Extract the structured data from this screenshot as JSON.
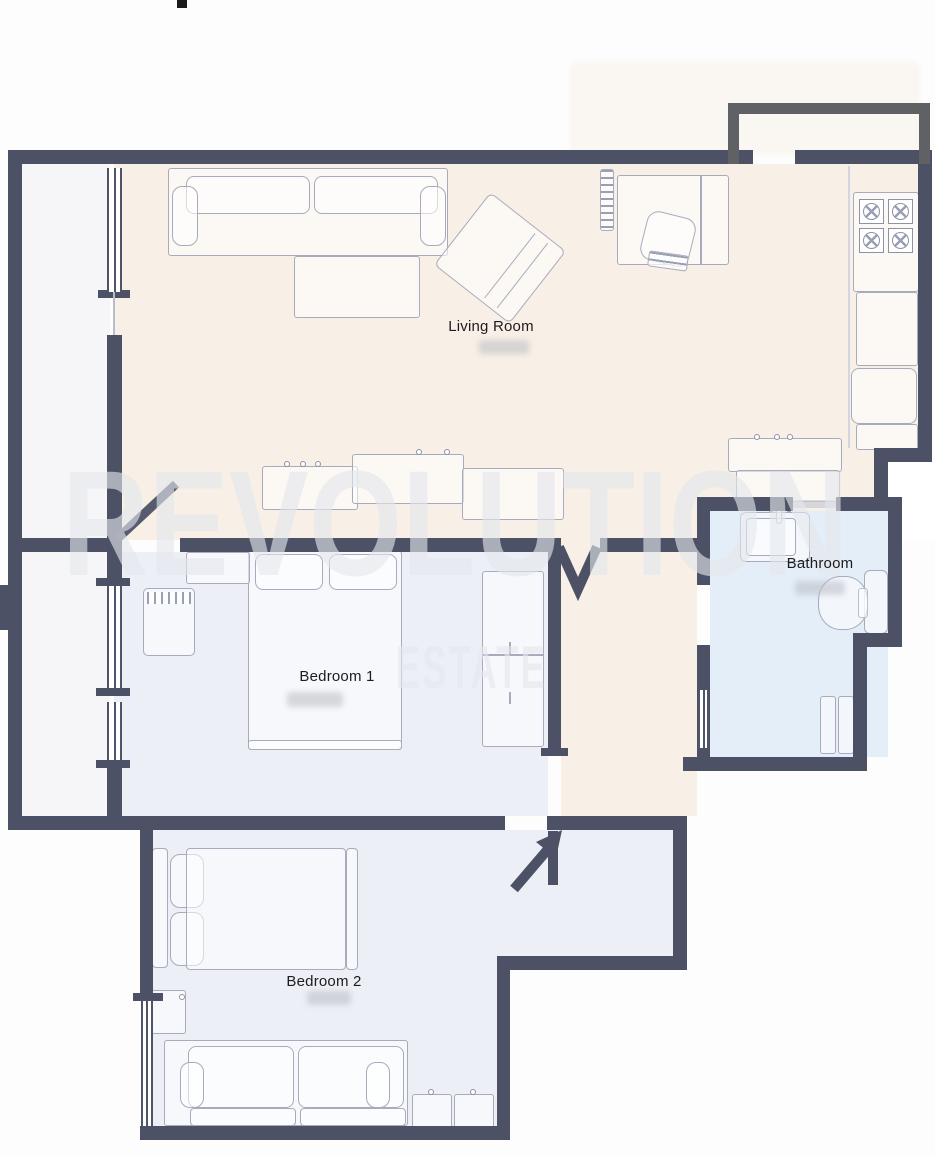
{
  "plan": {
    "type": "apartment-floor-plan",
    "watermark": {
      "line1": "REVOLUTION",
      "line2": "ESTATE"
    },
    "rooms": [
      {
        "id": "living-room",
        "label": "Living Room",
        "floor_color": "#f8efe6",
        "measurement_redacted": true,
        "furniture": [
          "sofa",
          "ottoman",
          "armchair",
          "tv-unit",
          "desk",
          "desk-chair",
          "kitchen-stove",
          "kitchen-counter",
          "kitchen-fridge",
          "kitchen-sink-counter",
          "island-counters"
        ]
      },
      {
        "id": "bedroom-1",
        "label": "Bedroom 1",
        "floor_color": "#edeff6",
        "measurement_redacted": true,
        "furniture": [
          "double-bed",
          "wardrobe",
          "dresser",
          "desk"
        ]
      },
      {
        "id": "bedroom-2",
        "label": "Bedroom 2",
        "floor_color": "#edeff6",
        "measurement_redacted": true,
        "furniture": [
          "double-bed",
          "sofa",
          "cabinets",
          "desk"
        ]
      },
      {
        "id": "bathroom",
        "label": "Bathroom",
        "floor_color": "#e4eef8",
        "measurement_redacted": true,
        "furniture": [
          "sink",
          "toilet",
          "shower"
        ]
      }
    ],
    "features": [
      "balcony-strip-left",
      "entry-vestibule-top-right",
      "door-swing-symbols",
      "windows-on-left-wall",
      "redacted-measurement-patches"
    ],
    "colors": {
      "wall": "#4c5166",
      "vestibule_wall": "#5f6164",
      "living_floor": "#f8efe6",
      "bedroom_floor": "#edeff6",
      "bathroom_floor": "#e4eef8",
      "balcony_floor": "#f6f6f8",
      "furniture_line": "#a7abbd",
      "label_text": "#1c1c20"
    }
  }
}
